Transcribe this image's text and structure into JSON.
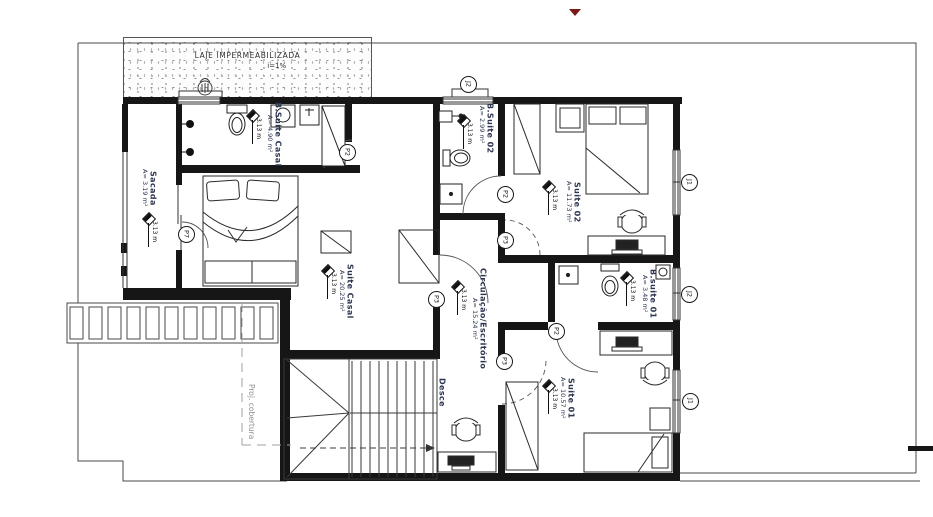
{
  "annotations": {
    "laje_title": "LAJE IMPERMEABILIZADA",
    "laje_slope": "i=1%",
    "stairs_direction": "Desce",
    "roof_projection": "Proj. cobertura"
  },
  "rooms": [
    {
      "name": "Sacada",
      "area": "A= 3.19 m²",
      "level": "3.13 m"
    },
    {
      "name": "B.Suite Casal",
      "area": "A= 4.90 m²",
      "level": "3.13 m"
    },
    {
      "name": "Suite Casal",
      "area": "A= 20.25 m²",
      "level": "3.13 m"
    },
    {
      "name": "B.Suite 02",
      "area": "A= 2.99 m²",
      "level": "3.13 m"
    },
    {
      "name": "Suite 02",
      "area": "A= 11.73 m²",
      "level": "3.13 m"
    },
    {
      "name": "Circulação/Escritório",
      "area": "A= 15.24 m²",
      "level": "3.13 m"
    },
    {
      "name": "B.suite 01",
      "area": "A= 3.48 m²",
      "level": "3.13 m"
    },
    {
      "name": "Suite 01",
      "area": "A= 10.57 m²",
      "level": "3.13 m"
    }
  ],
  "door_markers": [
    {
      "label": "P7"
    },
    {
      "label": "P2"
    },
    {
      "label": "P3"
    },
    {
      "label": "P2"
    },
    {
      "label": "P3"
    },
    {
      "label": "P2"
    },
    {
      "label": "P3"
    }
  ],
  "window_markers": [
    {
      "label": "J2"
    },
    {
      "label": "J1"
    },
    {
      "label": "J2"
    },
    {
      "label": "J1"
    }
  ],
  "colors": {
    "wall": "#161616",
    "label_text": "#2b3550",
    "muted_text": "#8f8f8f",
    "accent_red": "#7c1818"
  }
}
